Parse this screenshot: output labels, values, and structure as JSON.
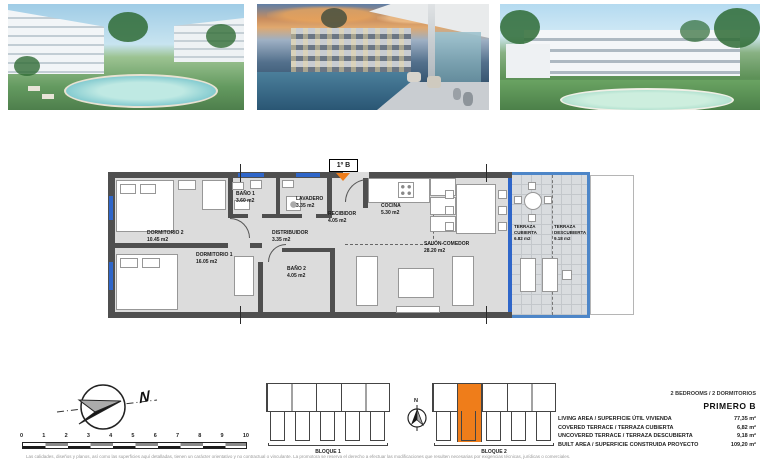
{
  "photos": [
    {
      "name": "pool-garden-day-render"
    },
    {
      "name": "dusk-terrace-pool-render"
    },
    {
      "name": "building-lawn-pool-render"
    }
  ],
  "plan": {
    "unit_label": "1º B",
    "rooms": [
      {
        "name": "DORMITORIO 2",
        "area": "10.45 m2"
      },
      {
        "name": "DORMITORIO 1",
        "area": "16.05 m2"
      },
      {
        "name": "BAÑO 1",
        "area": "3.60 m2"
      },
      {
        "name": "LAVADERO",
        "area": "3.35 m2"
      },
      {
        "name": "RECIBIDOR",
        "area": "4.05 m2"
      },
      {
        "name": "DISTRIBUIDOR",
        "area": "3.35 m2"
      },
      {
        "name": "BAÑO 2",
        "area": "4.05 m2"
      },
      {
        "name": "COCINA",
        "area": "5.30 m2"
      },
      {
        "name": "SALÓN-COMEDOR",
        "area": "28.20 m2"
      },
      {
        "name": "TERRAZA CUBIERTA",
        "area": "6.82 m2"
      },
      {
        "name": "TERRAZA DESCUBIERTA",
        "area": "9.18 m2"
      }
    ]
  },
  "compass": {
    "north_label": "N"
  },
  "site_compass": {
    "north_label": "N"
  },
  "scalebar": {
    "ticks": [
      "0",
      "1",
      "2",
      "3",
      "4",
      "5",
      "6",
      "7",
      "8",
      "9",
      "10"
    ]
  },
  "keyplan": {
    "block1_label": "BLOQUE 1",
    "block2_label": "BLOQUE 2"
  },
  "summary": {
    "bedrooms": "2 BEDROOMS / 2 DORMITORIOS",
    "unit_name": "PRIMERO B",
    "rows": [
      {
        "label": "LIVING AREA / SUPERFICIE ÚTIL VIVIENDA",
        "value": "77,35 m²"
      },
      {
        "label": "COVERED TERRACE / TERRAZA CUBIERTA",
        "value": "6,82 m²"
      },
      {
        "label": "UNCOVERED TERRACE / TERRAZA DESCUBIERTA",
        "value": "9,18 m²"
      },
      {
        "label": "BUILT AREA / SUPERFICIE CONSTRUIDA PROYECTO",
        "value": "109,20 m²"
      }
    ]
  },
  "disclaimer": "Las calidades, diseños y planos, así como las superficies aquí detalladas, tienen un carácter orientativo y no contractual o vinculante. La promotora se reserva el derecho a efectuar las modificaciones que resulten necesarias por exigencias técnicas, jurídicas o comerciales.",
  "colors": {
    "accent_orange": "#EF7D1A",
    "window_blue": "#2F66C9",
    "wall_gray": "#4F4F4F",
    "floor_gray": "#DCDCDC",
    "terrace_blue": "#4D86C8"
  }
}
